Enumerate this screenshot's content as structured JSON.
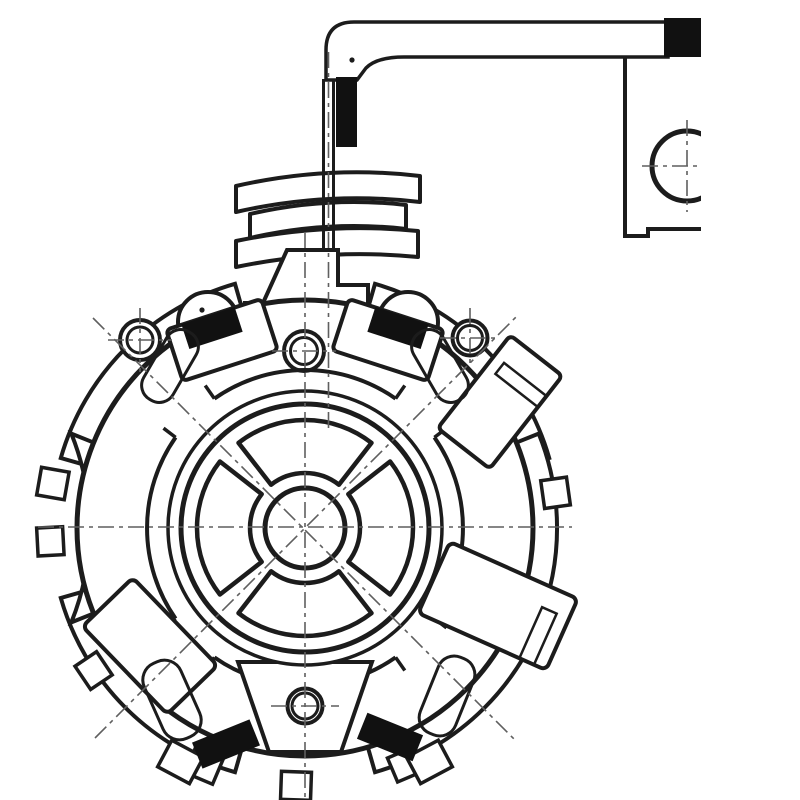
{
  "meta": {
    "description": "Black and white engineering cross-section drawing of a starter motor brush holder assembly with terminal arm, washer stack, four brush units and mounting bracket",
    "drawing_kind": "technical-line-drawing",
    "visible_text": ""
  },
  "palette": {
    "background": "#ffffff",
    "ink": "#1c1c1c",
    "solid_black": "#111111",
    "centerline": "#5f5f5f"
  },
  "parts": {
    "terminal_arm": "hatched L-shaped terminal strap with black end cap",
    "terminal_stud": "vertical stud with black insulator block",
    "washer_stack": "three curved insulator washers",
    "mount_post": "trapezoid terminal post on plate",
    "brush_plate": "circular brush holder plate",
    "hub": "central hub with four fan cutouts and shaft hole",
    "brush_units": "four diagonal brush boxes with black brushes and hatched coil springs",
    "screw_holes": "four pivot holes with centerline crosshairs",
    "bracket": "right-side mounting bracket with through hole clipped by image edge"
  }
}
